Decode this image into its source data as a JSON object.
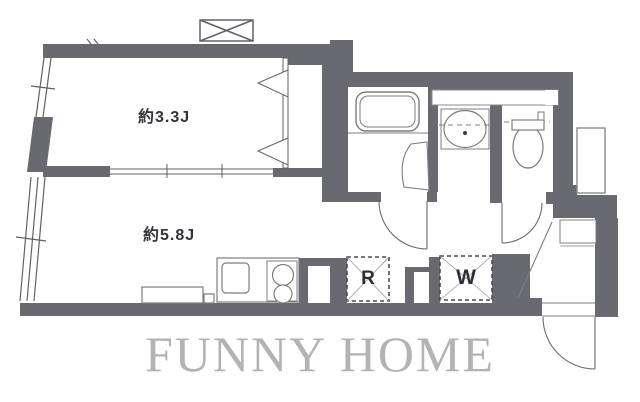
{
  "rooms": {
    "room1": {
      "label": "約3.3J"
    },
    "room2": {
      "label": "約5.8J"
    }
  },
  "spots": {
    "refrigerator": {
      "label": "R"
    },
    "washer": {
      "label": "W"
    }
  },
  "watermark": {
    "text": "FUNNY HOME"
  },
  "colors": {
    "wall": "#696971",
    "line": "#60606a",
    "fixture": "#7c7c84",
    "label_text": "#33333b",
    "watermark_text": "#b2b2b7",
    "background": "#ffffff"
  }
}
